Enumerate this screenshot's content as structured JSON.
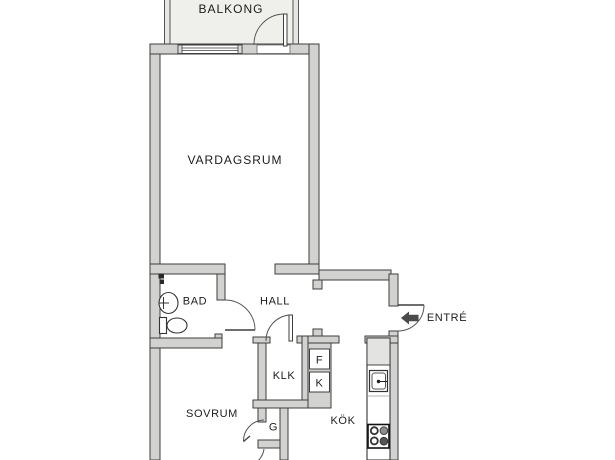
{
  "plan": {
    "type": "apartment-floor-plan",
    "labels": {
      "balkong": "BALKONG",
      "vardagsrum": "VARDAGSRUM",
      "bad": "BAD",
      "hall": "HALL",
      "entre": "ENTRÉ",
      "klk": "KLK",
      "sovrum": "SOVRUM",
      "kok": "KÖK",
      "garderob": "G",
      "fridge": "F",
      "freezer": "K"
    },
    "icons": {
      "entry_arrow": "left-arrow",
      "sink": "bathroom-sink",
      "toilet": "toilet",
      "kitchen_sink": "kitchen-sink",
      "stove": "four-burner-stove"
    },
    "colors": {
      "wall_fill": "#d2d2d0",
      "wall_stroke": "#3e3e3e",
      "balcony_fill": "#efefec",
      "cabinet_fill": "#e3e3e1",
      "arrow": "#4a4a4a",
      "text": "#1c1c1c",
      "background": "#ffffff"
    }
  }
}
